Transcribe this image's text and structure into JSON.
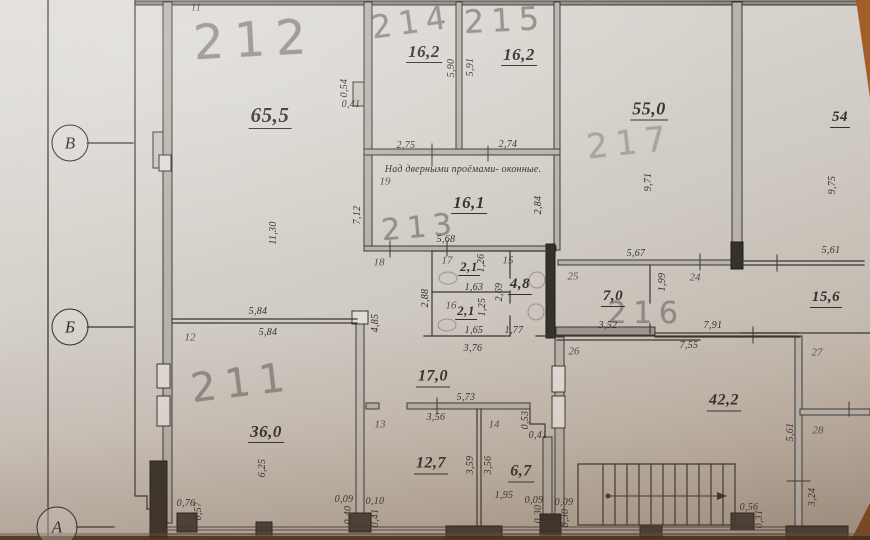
{
  "title": "Floor plan photo, second floor rooms 211-217",
  "note": "Над дверными проёмами- оконные.",
  "rooms": [
    {
      "number": "211",
      "area": "36,0"
    },
    {
      "number": "212",
      "area": "65,5"
    },
    {
      "number": "213",
      "area": "16,1"
    },
    {
      "number": "214",
      "area": "16,2"
    },
    {
      "number": "215",
      "area": "16,2"
    },
    {
      "number": "216",
      "area": "7,0"
    },
    {
      "number": "217",
      "area": "55,0"
    }
  ],
  "colors": {
    "paper": "#d8d5cf",
    "line": "#3a3631",
    "pencil": "#84807a",
    "table": "#a25d28"
  },
  "labels": [
    {
      "k": "axis",
      "t": "В",
      "x": 70,
      "y": 143,
      "d": 35
    },
    {
      "k": "axis",
      "t": "Б",
      "x": 70,
      "y": 327,
      "d": 35
    },
    {
      "k": "axis",
      "t": "А",
      "x": 57,
      "y": 527,
      "d": 39
    },
    {
      "k": "hand",
      "t": "212",
      "x": 255,
      "y": 40,
      "s": 48,
      "r": -3
    },
    {
      "k": "hand",
      "t": "214",
      "x": 412,
      "y": 22,
      "s": 32,
      "r": -8
    },
    {
      "k": "hand",
      "t": "215",
      "x": 505,
      "y": 20,
      "s": 32,
      "r": -3
    },
    {
      "k": "hand",
      "t": "217",
      "x": 630,
      "y": 143,
      "s": 34,
      "r": -6,
      "o": 0.55
    },
    {
      "k": "hand",
      "t": "213",
      "x": 420,
      "y": 228,
      "s": 30,
      "r": -5
    },
    {
      "k": "hand",
      "t": "216",
      "x": 646,
      "y": 314,
      "s": 30,
      "r": 0
    },
    {
      "k": "hand",
      "t": "211",
      "x": 242,
      "y": 383,
      "s": 40,
      "r": -7
    },
    {
      "k": "area",
      "t": "65,5",
      "x": 270,
      "y": 117,
      "s": 21
    },
    {
      "k": "area",
      "t": "16,2",
      "x": 424,
      "y": 53,
      "s": 17
    },
    {
      "k": "area",
      "t": "16,2",
      "x": 519,
      "y": 56,
      "s": 17
    },
    {
      "k": "area",
      "t": "55,0",
      "x": 649,
      "y": 110,
      "s": 18
    },
    {
      "k": "area",
      "t": "54",
      "x": 840,
      "y": 119,
      "s": 15
    },
    {
      "k": "area",
      "t": "16,1",
      "x": 469,
      "y": 204,
      "s": 17
    },
    {
      "k": "area",
      "t": "2,1",
      "x": 469,
      "y": 268,
      "s": 13
    },
    {
      "k": "area",
      "t": "4,8",
      "x": 520,
      "y": 286,
      "s": 15
    },
    {
      "k": "area",
      "t": "2,1",
      "x": 466,
      "y": 312,
      "s": 13
    },
    {
      "k": "area",
      "t": "7,0",
      "x": 613,
      "y": 298,
      "s": 15
    },
    {
      "k": "area",
      "t": "15,6",
      "x": 826,
      "y": 299,
      "s": 15
    },
    {
      "k": "area",
      "t": "17,0",
      "x": 433,
      "y": 378,
      "s": 16
    },
    {
      "k": "area",
      "t": "36,0",
      "x": 266,
      "y": 433,
      "s": 17
    },
    {
      "k": "area",
      "t": "12,7",
      "x": 431,
      "y": 465,
      "s": 16
    },
    {
      "k": "area",
      "t": "6,7",
      "x": 521,
      "y": 473,
      "s": 16
    },
    {
      "k": "area",
      "t": "42,2",
      "x": 724,
      "y": 402,
      "s": 16
    },
    {
      "k": "note",
      "t": "Над дверными проёмами- оконные.",
      "x": 463,
      "y": 170
    },
    {
      "k": "node",
      "t": "11",
      "x": 196,
      "y": 8
    },
    {
      "k": "node",
      "t": "19",
      "x": 385,
      "y": 182
    },
    {
      "k": "node",
      "t": "18",
      "x": 379,
      "y": 263
    },
    {
      "k": "node",
      "t": "17",
      "x": 447,
      "y": 261
    },
    {
      "k": "node",
      "t": "15",
      "x": 508,
      "y": 261
    },
    {
      "k": "node",
      "t": "16",
      "x": 451,
      "y": 306
    },
    {
      "k": "node",
      "t": "12",
      "x": 190,
      "y": 338
    },
    {
      "k": "node",
      "t": "25",
      "x": 573,
      "y": 277
    },
    {
      "k": "node",
      "t": "24",
      "x": 695,
      "y": 278
    },
    {
      "k": "node",
      "t": "26",
      "x": 574,
      "y": 352
    },
    {
      "k": "node",
      "t": "13",
      "x": 380,
      "y": 425
    },
    {
      "k": "node",
      "t": "14",
      "x": 494,
      "y": 425
    },
    {
      "k": "node",
      "t": "27",
      "x": 817,
      "y": 353
    },
    {
      "k": "node",
      "t": "28",
      "x": 818,
      "y": 431
    },
    {
      "k": "dh",
      "t": "0,41",
      "x": 351,
      "y": 105
    },
    {
      "k": "dh",
      "t": "2,75",
      "x": 406,
      "y": 146
    },
    {
      "k": "dh",
      "t": "2,74",
      "x": 508,
      "y": 145
    },
    {
      "k": "dh",
      "t": "5,68",
      "x": 446,
      "y": 240
    },
    {
      "k": "dh",
      "t": "1,63",
      "x": 474,
      "y": 288
    },
    {
      "k": "dh",
      "t": "1,65",
      "x": 474,
      "y": 331
    },
    {
      "k": "dh",
      "t": "1,77",
      "x": 514,
      "y": 331
    },
    {
      "k": "dh",
      "t": "3,76",
      "x": 473,
      "y": 349
    },
    {
      "k": "dh",
      "t": "5,67",
      "x": 636,
      "y": 254
    },
    {
      "k": "dh",
      "t": "3,52",
      "x": 608,
      "y": 326
    },
    {
      "k": "dh",
      "t": "7,91",
      "x": 713,
      "y": 326
    },
    {
      "k": "dh",
      "t": "7,55",
      "x": 689,
      "y": 346
    },
    {
      "k": "dh",
      "t": "5,61",
      "x": 831,
      "y": 251
    },
    {
      "k": "dh",
      "t": "5,84",
      "x": 258,
      "y": 312
    },
    {
      "k": "dh",
      "t": "5,84",
      "x": 268,
      "y": 333
    },
    {
      "k": "dh",
      "t": "5,73",
      "x": 466,
      "y": 398
    },
    {
      "k": "dh",
      "t": "3,56",
      "x": 436,
      "y": 418
    },
    {
      "k": "dh",
      "t": "0,41",
      "x": 538,
      "y": 436
    },
    {
      "k": "dh",
      "t": "1,95",
      "x": 504,
      "y": 496
    },
    {
      "k": "dh",
      "t": "0,76",
      "x": 186,
      "y": 504
    },
    {
      "k": "dh",
      "t": "0,09",
      "x": 344,
      "y": 500
    },
    {
      "k": "dh",
      "t": "0,10",
      "x": 375,
      "y": 502
    },
    {
      "k": "dh",
      "t": "0,09",
      "x": 534,
      "y": 501
    },
    {
      "k": "dh",
      "t": "0,09",
      "x": 564,
      "y": 503
    },
    {
      "k": "dh",
      "t": "0,56",
      "x": 749,
      "y": 508
    },
    {
      "k": "dv",
      "t": "0,54",
      "x": 345,
      "y": 88
    },
    {
      "k": "dv",
      "t": "5,90",
      "x": 452,
      "y": 68
    },
    {
      "k": "dv",
      "t": "5,91",
      "x": 471,
      "y": 67
    },
    {
      "k": "dv",
      "t": "9,71",
      "x": 649,
      "y": 182
    },
    {
      "k": "dv",
      "t": "9,75",
      "x": 833,
      "y": 185
    },
    {
      "k": "dv",
      "t": "11,30",
      "x": 274,
      "y": 233
    },
    {
      "k": "dv",
      "t": "7,12",
      "x": 358,
      "y": 215
    },
    {
      "k": "dv",
      "t": "2,84",
      "x": 539,
      "y": 205
    },
    {
      "k": "dv",
      "t": "1,26",
      "x": 482,
      "y": 263
    },
    {
      "k": "dv",
      "t": "2,69",
      "x": 500,
      "y": 292
    },
    {
      "k": "dv",
      "t": "2,88",
      "x": 426,
      "y": 298
    },
    {
      "k": "dv",
      "t": "1,25",
      "x": 483,
      "y": 307
    },
    {
      "k": "dv",
      "t": "4,85",
      "x": 376,
      "y": 323
    },
    {
      "k": "dv",
      "t": "1,99",
      "x": 663,
      "y": 282
    },
    {
      "k": "dv",
      "t": "3,59",
      "x": 471,
      "y": 465
    },
    {
      "k": "dv",
      "t": "3,56",
      "x": 489,
      "y": 465
    },
    {
      "k": "dv",
      "t": "0,53",
      "x": 526,
      "y": 420
    },
    {
      "k": "dv",
      "t": "6,25",
      "x": 263,
      "y": 468
    },
    {
      "k": "dv",
      "t": "0,57",
      "x": 199,
      "y": 511
    },
    {
      "k": "dv",
      "t": "0,40",
      "x": 349,
      "y": 515
    },
    {
      "k": "dv",
      "t": "0,41",
      "x": 376,
      "y": 518
    },
    {
      "k": "dv",
      "t": "0,30",
      "x": 539,
      "y": 514
    },
    {
      "k": "dv",
      "t": "0,30",
      "x": 566,
      "y": 518
    },
    {
      "k": "dv",
      "t": "0,31",
      "x": 760,
      "y": 519
    },
    {
      "k": "dv",
      "t": "5,61",
      "x": 791,
      "y": 432
    },
    {
      "k": "dv",
      "t": "3,24",
      "x": 813,
      "y": 497
    }
  ]
}
